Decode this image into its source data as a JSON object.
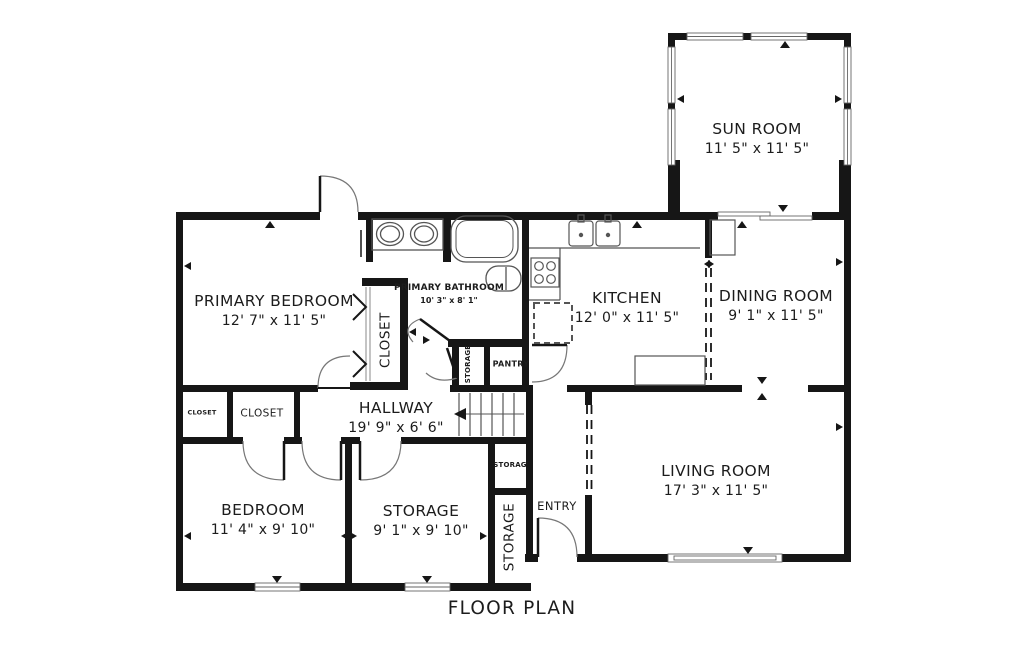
{
  "title": {
    "label": "FLOOR PLAN"
  },
  "colors": {
    "wall": "#161616",
    "fixture": "#555555",
    "text": "#1c1c1c",
    "background": "#ffffff"
  },
  "rooms": {
    "sun_room": {
      "name": "SUN ROOM",
      "dims": "11' 5\" x 11' 5\""
    },
    "primary_bedroom": {
      "name": "PRIMARY BEDROOM",
      "dims": "12' 7\" x 11' 5\""
    },
    "primary_bathroom": {
      "name": "PRIMARY BATHROOM",
      "dims": "10' 3\" x 8' 1\""
    },
    "kitchen": {
      "name": "KITCHEN",
      "dims": "12' 0\" x 11' 5\""
    },
    "dining_room": {
      "name": "DINING ROOM",
      "dims": "9' 1\" x 11' 5\""
    },
    "living_room": {
      "name": "LIVING ROOM",
      "dims": "17' 3\" x 11' 5\""
    },
    "hallway": {
      "name": "HALLWAY",
      "dims": "19' 9\" x 6' 6\""
    },
    "bedroom": {
      "name": "BEDROOM",
      "dims": "11' 4\" x 9' 10\""
    },
    "storage_room": {
      "name": "STORAGE",
      "dims": "9' 1\" x 9' 10\""
    },
    "entry": {
      "name": "ENTRY"
    },
    "pantry": {
      "name": "PANTRY"
    },
    "closet_primary": {
      "name": "CLOSET"
    },
    "closet_hall": {
      "name": "CLOSET"
    },
    "closet_hall_small": {
      "name": "CLOSET"
    },
    "storage_hall_closet": {
      "name": "STORAGE"
    },
    "storage_under_stairs": {
      "name": "STORAG"
    },
    "storage_entry": {
      "name": "STORAGE"
    }
  }
}
